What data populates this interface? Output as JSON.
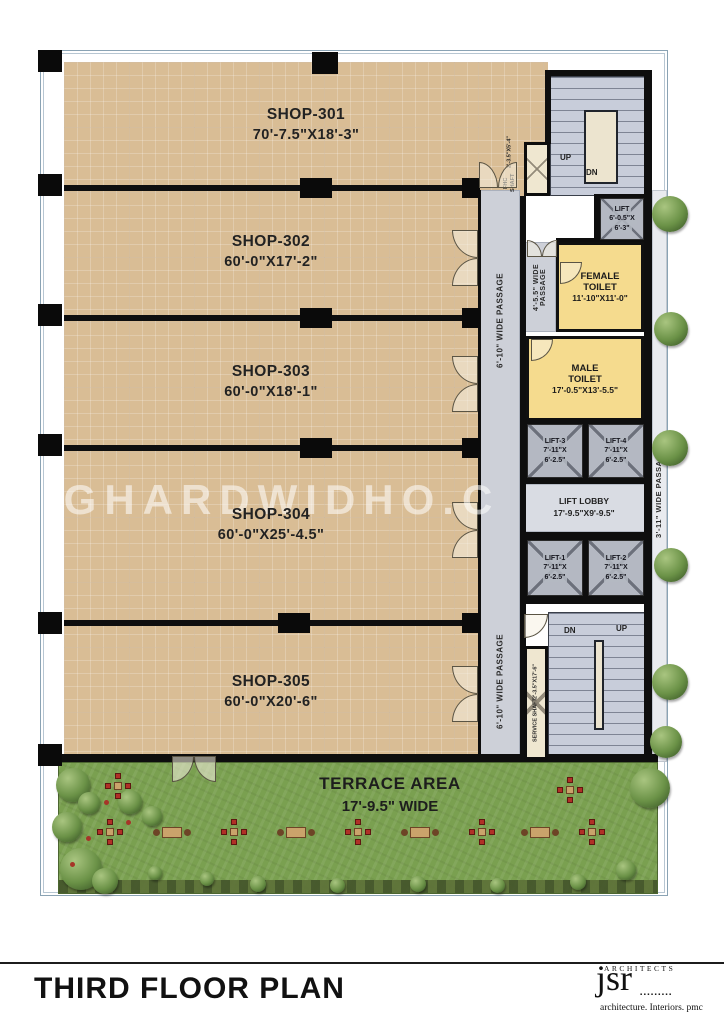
{
  "page": {
    "title": "THIRD FLOOR PLAN"
  },
  "watermark": "GHARDWIDHO.C",
  "logo": {
    "label": "ARCHITECTS",
    "name": "jsr",
    "dots": "▪▪▪▪▪▪▪▪▪",
    "tagline": "architecture. Interiors. pmc"
  },
  "shops": [
    {
      "name": "SHOP-301",
      "dim": "70'-7.5\"X18'-3\""
    },
    {
      "name": "SHOP-302",
      "dim": "60'-0\"X17'-2\""
    },
    {
      "name": "SHOP-303",
      "dim": "60'-0\"X18'-1\""
    },
    {
      "name": "SHOP-304",
      "dim": "60'-0\"X25'-4.5\""
    },
    {
      "name": "SHOP-305",
      "dim": "60'-0\"X20'-6\""
    }
  ],
  "passages": {
    "main_upper": "6'-10\" WIDE PASSAGE",
    "main_lower": "6'-10\" WIDE PASSAGE",
    "toilet": "4'-5.5\" WIDE PASSAGE",
    "right": "3'-11\" WIDE PASSAGE"
  },
  "stairs": {
    "top": {
      "up": "UP",
      "dn": "DN"
    },
    "bottom": {
      "up": "UP",
      "dn": "DN"
    }
  },
  "shafts": {
    "fhc": {
      "name": "FHC SHAFT",
      "dim": "2'-3.5\"X5'-4\""
    },
    "service": {
      "name": "SERVICE SHAFT",
      "dim": "2'-3.5\"X17'-6\""
    }
  },
  "rooms": {
    "lift_top": {
      "name": "LIFT",
      "dim1": "6'-0.5\"X",
      "dim2": "6'-3\""
    },
    "female_toilet": {
      "line1": "FEMALE",
      "line2": "TOILET",
      "dim": "11'-10\"X11'-0\""
    },
    "male_toilet": {
      "line1": "MALE",
      "line2": "TOILET",
      "dim": "17'-0.5\"X13'-5.5\""
    },
    "lift1": {
      "name": "LIFT-1",
      "dim1": "7'-11\"X",
      "dim2": "6'-2.5\""
    },
    "lift2": {
      "name": "LIFT-2",
      "dim1": "7'-11\"X",
      "dim2": "6'-2.5\""
    },
    "lift3": {
      "name": "LIFT-3",
      "dim1": "7'-11\"X",
      "dim2": "6'-2.5\""
    },
    "lift4": {
      "name": "LIFT-4",
      "dim1": "7'-11\"X",
      "dim2": "6'-2.5\""
    },
    "lift_lobby": {
      "name": "LIFT LOBBY",
      "dim": "17'-9.5\"X9'-9.5\""
    }
  },
  "terrace": {
    "name": "TERRACE AREA",
    "dim": "17'-9.5\" WIDE"
  },
  "colors": {
    "shop_fill": "#d9bd95",
    "toilet_fill": "#f5db8e",
    "passage_fill": "#cdd0d8",
    "stair_fill": "#c8cdda",
    "wall": "#0e0e0e",
    "terrace_green": "#7aa050"
  }
}
